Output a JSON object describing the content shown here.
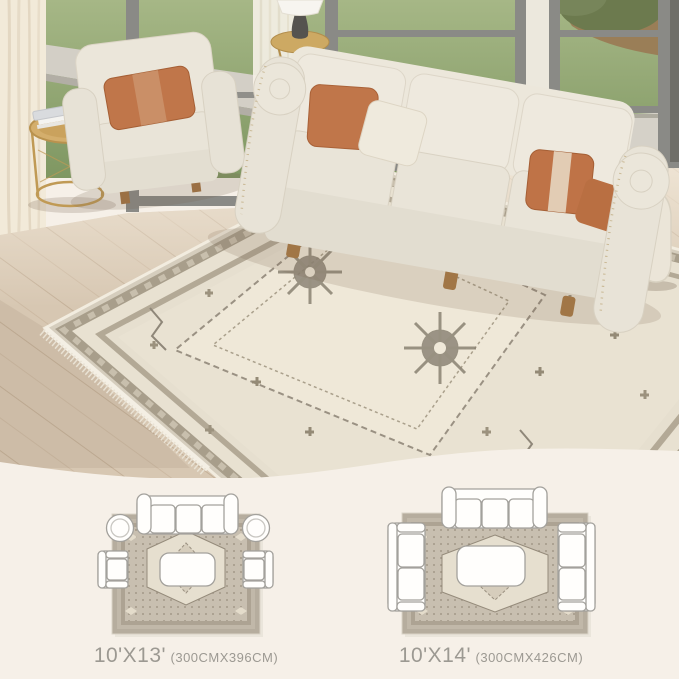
{
  "canvas": {
    "background": "#f6f0e8"
  },
  "scene": {
    "name": "living-room-with-vintage-area-rug",
    "colors": {
      "grass": "#8fa369",
      "walkway": "#d3cfc6",
      "window_frame": "#8a8a86",
      "curtain": "#f2ead9",
      "wood_floor": "#d7c7b2",
      "sofa_cream": "#e9e4d8",
      "pillow_rust": "#c0764a",
      "rug_field": "#e9e2d2",
      "rug_border": "#a89e8b",
      "rug_motif": "#8d8577",
      "table_gold": "#cda963",
      "vase_cream": "#ebe5d8",
      "label_gray": "#9c9992"
    }
  },
  "size_options": [
    {
      "size": "10'X13'",
      "metric": "(300CMX396CM)"
    },
    {
      "size": "10'X14'",
      "metric": "(300CMX426CM)"
    }
  ]
}
